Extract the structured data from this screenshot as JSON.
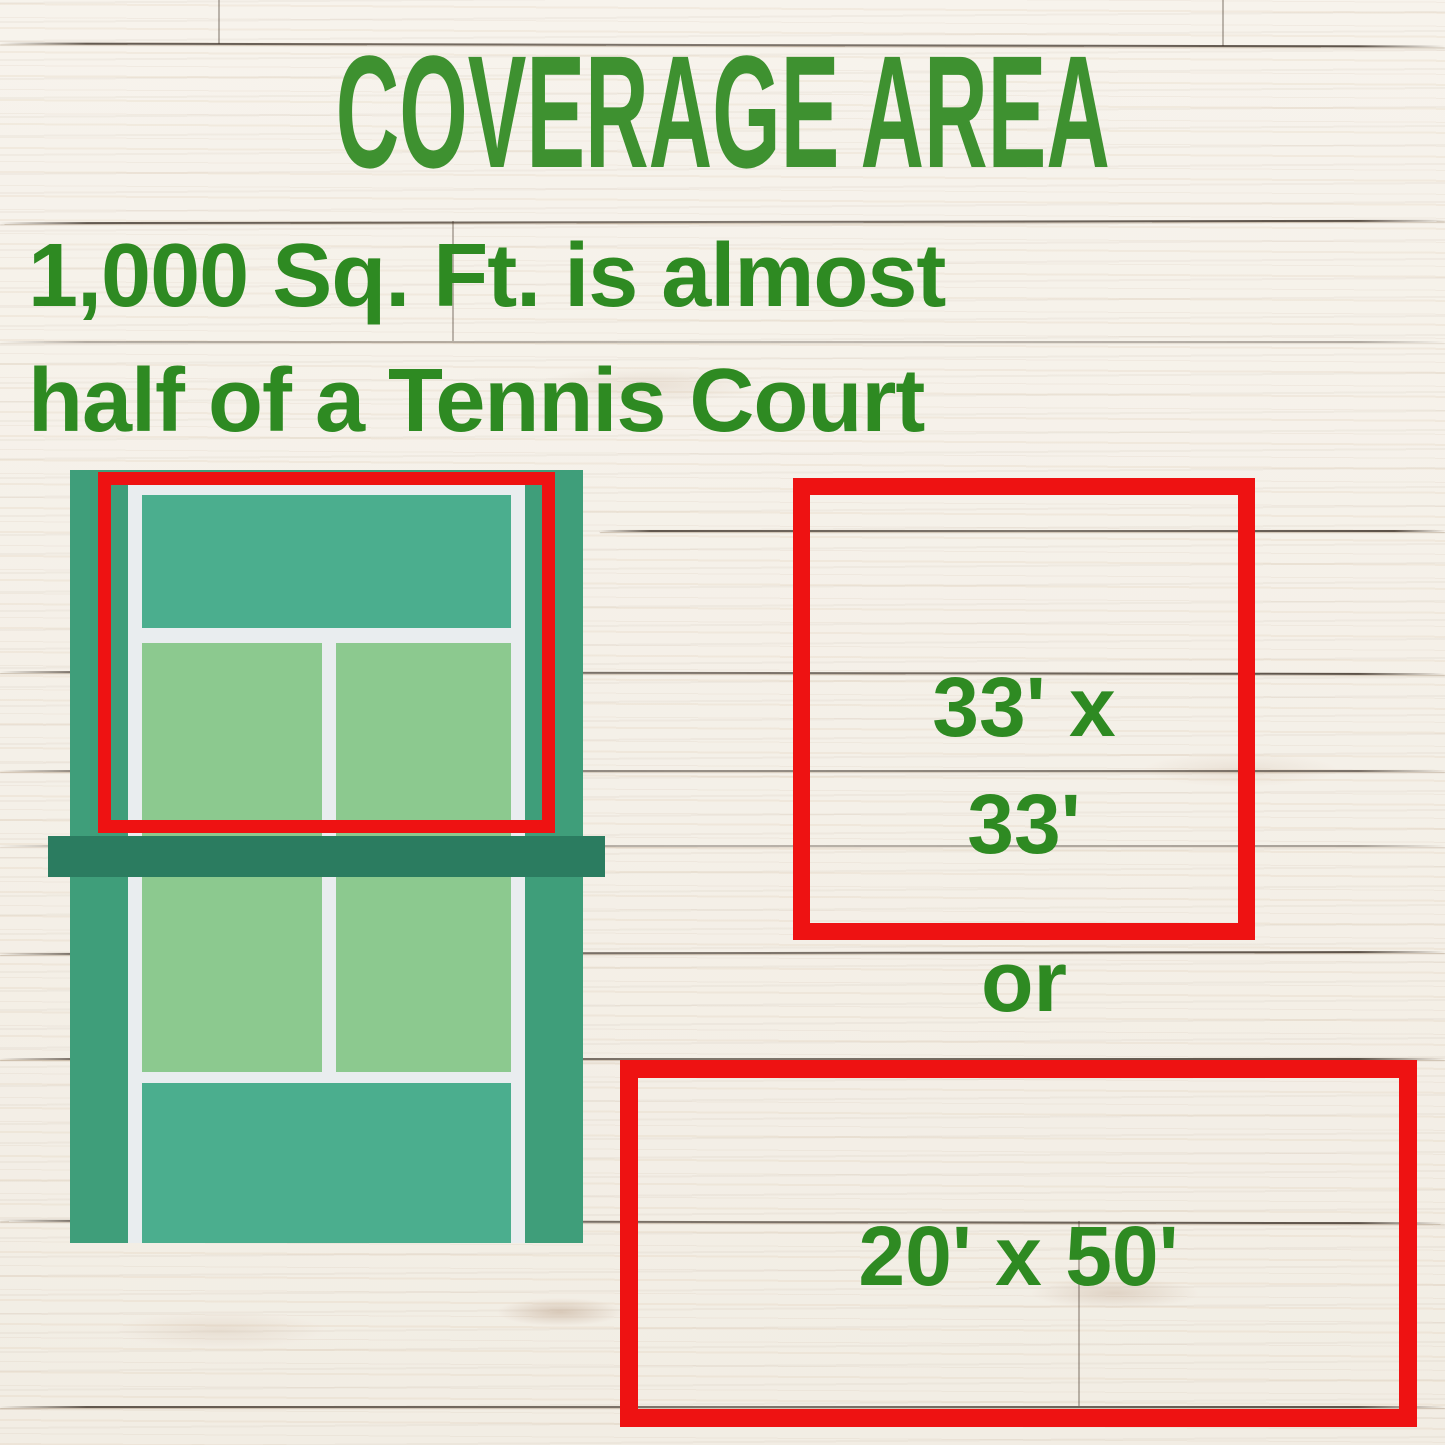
{
  "title": "COVERAGE AREA",
  "subtitle": {
    "line1": "1,000 Sq. Ft. is almost",
    "line2": "half of a Tennis Court"
  },
  "coverage_options": {
    "square": {
      "line1": "33' x",
      "line2": "33'"
    },
    "separator": "or",
    "rectangle": {
      "label": "20' x 50'"
    }
  },
  "illustration": {
    "name": "tennis-court-top-view",
    "highlighted_region": "upper half of court outlined in red"
  },
  "colors": {
    "accent_red": "#ee1212",
    "title_green": "#3e9130",
    "text_green": "#2e8a22",
    "court_green": "#3f9e7a",
    "court_teal": "#4bae8e",
    "court_light_green": "#8cc98f",
    "net_green": "#2b7c60",
    "court_line_white": "#e9edef",
    "wood_base": "#f4f0e8"
  }
}
